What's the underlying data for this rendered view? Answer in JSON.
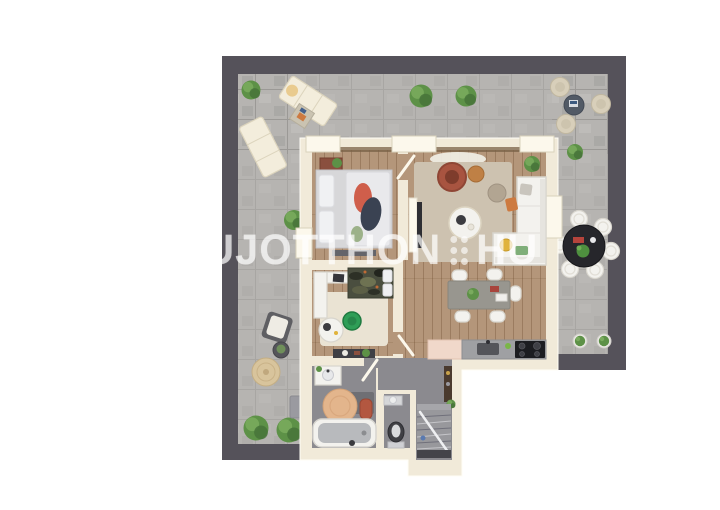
{
  "watermark": {
    "brand_left": "UJOTTHON",
    "brand_right": "HU",
    "separator_dots": 6
  },
  "palette": {
    "paper": "#ffffff",
    "terrace": "#b6b4b1",
    "deck": "#55525a",
    "wall": "#f1ead9",
    "wall-bright": "#fcf8ec",
    "wood": "#b4967a",
    "gray-floor": "#8b8a8f",
    "rug-living": "#cdc2b0",
    "rug-room2": "#eae3d3",
    "rug-bath": "#e3b58c",
    "white-furn": "#f3f2ee",
    "white-furn-stroke": "#d8d5cd",
    "dark-furn": "#3c3c41",
    "rust": "#a85440",
    "orange": "#cd7a40",
    "green": "#5d9147",
    "counter": "#9fa0a3",
    "pink-cabinet": "#f0d8ca",
    "watermark": "rgba(255,255,255,0.62)"
  }
}
